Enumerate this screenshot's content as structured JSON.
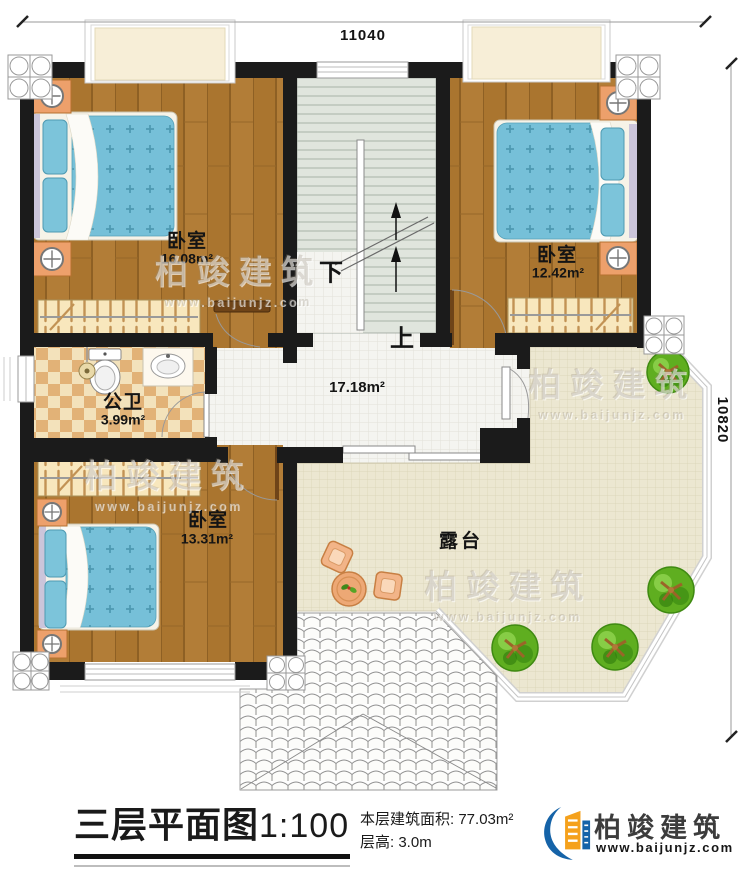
{
  "plan": {
    "dimension_top": "11040",
    "dimension_right": "10820",
    "rooms": {
      "bedroom_top_left": {
        "label": "卧室",
        "area": "16.08m²"
      },
      "bedroom_top_right": {
        "label": "卧室",
        "area": "12.42m²"
      },
      "bedroom_bottom_left": {
        "label": "卧室",
        "area": "13.31m²"
      },
      "bathroom": {
        "label": "公卫",
        "area": "3.99m²"
      },
      "hall": {
        "area": "17.18m²"
      },
      "terrace": {
        "label": "露台"
      }
    },
    "stairs": {
      "down_label": "下",
      "up_label": "上"
    }
  },
  "title_block": {
    "title": "三层平面图",
    "scale": "1:100",
    "floor_area_label": "本层建筑面积:",
    "floor_area_value": "77.03m²",
    "floor_height_label": "层高:",
    "floor_height_value": "3.0m"
  },
  "brand": {
    "name": "柏竣建筑",
    "website": "www.baijunjz.com"
  },
  "watermark": {
    "text": "柏竣建筑",
    "subtext": "www.baijunjz.com"
  },
  "colors": {
    "wall": "#1b1b1b",
    "wood_floor": "#b17c35",
    "bed_blue": "#76c0d8",
    "bath_checker": "#dfa96b",
    "stair_floor": "#e0e5dd",
    "hall_tile": "#f4f4f0",
    "terrace_tile": "#ece7d1",
    "tree_green": "#5fae20",
    "nightstand_orange": "#eda06b",
    "logo_blue": "#1563a8",
    "logo_orange": "#f5a11c"
  }
}
